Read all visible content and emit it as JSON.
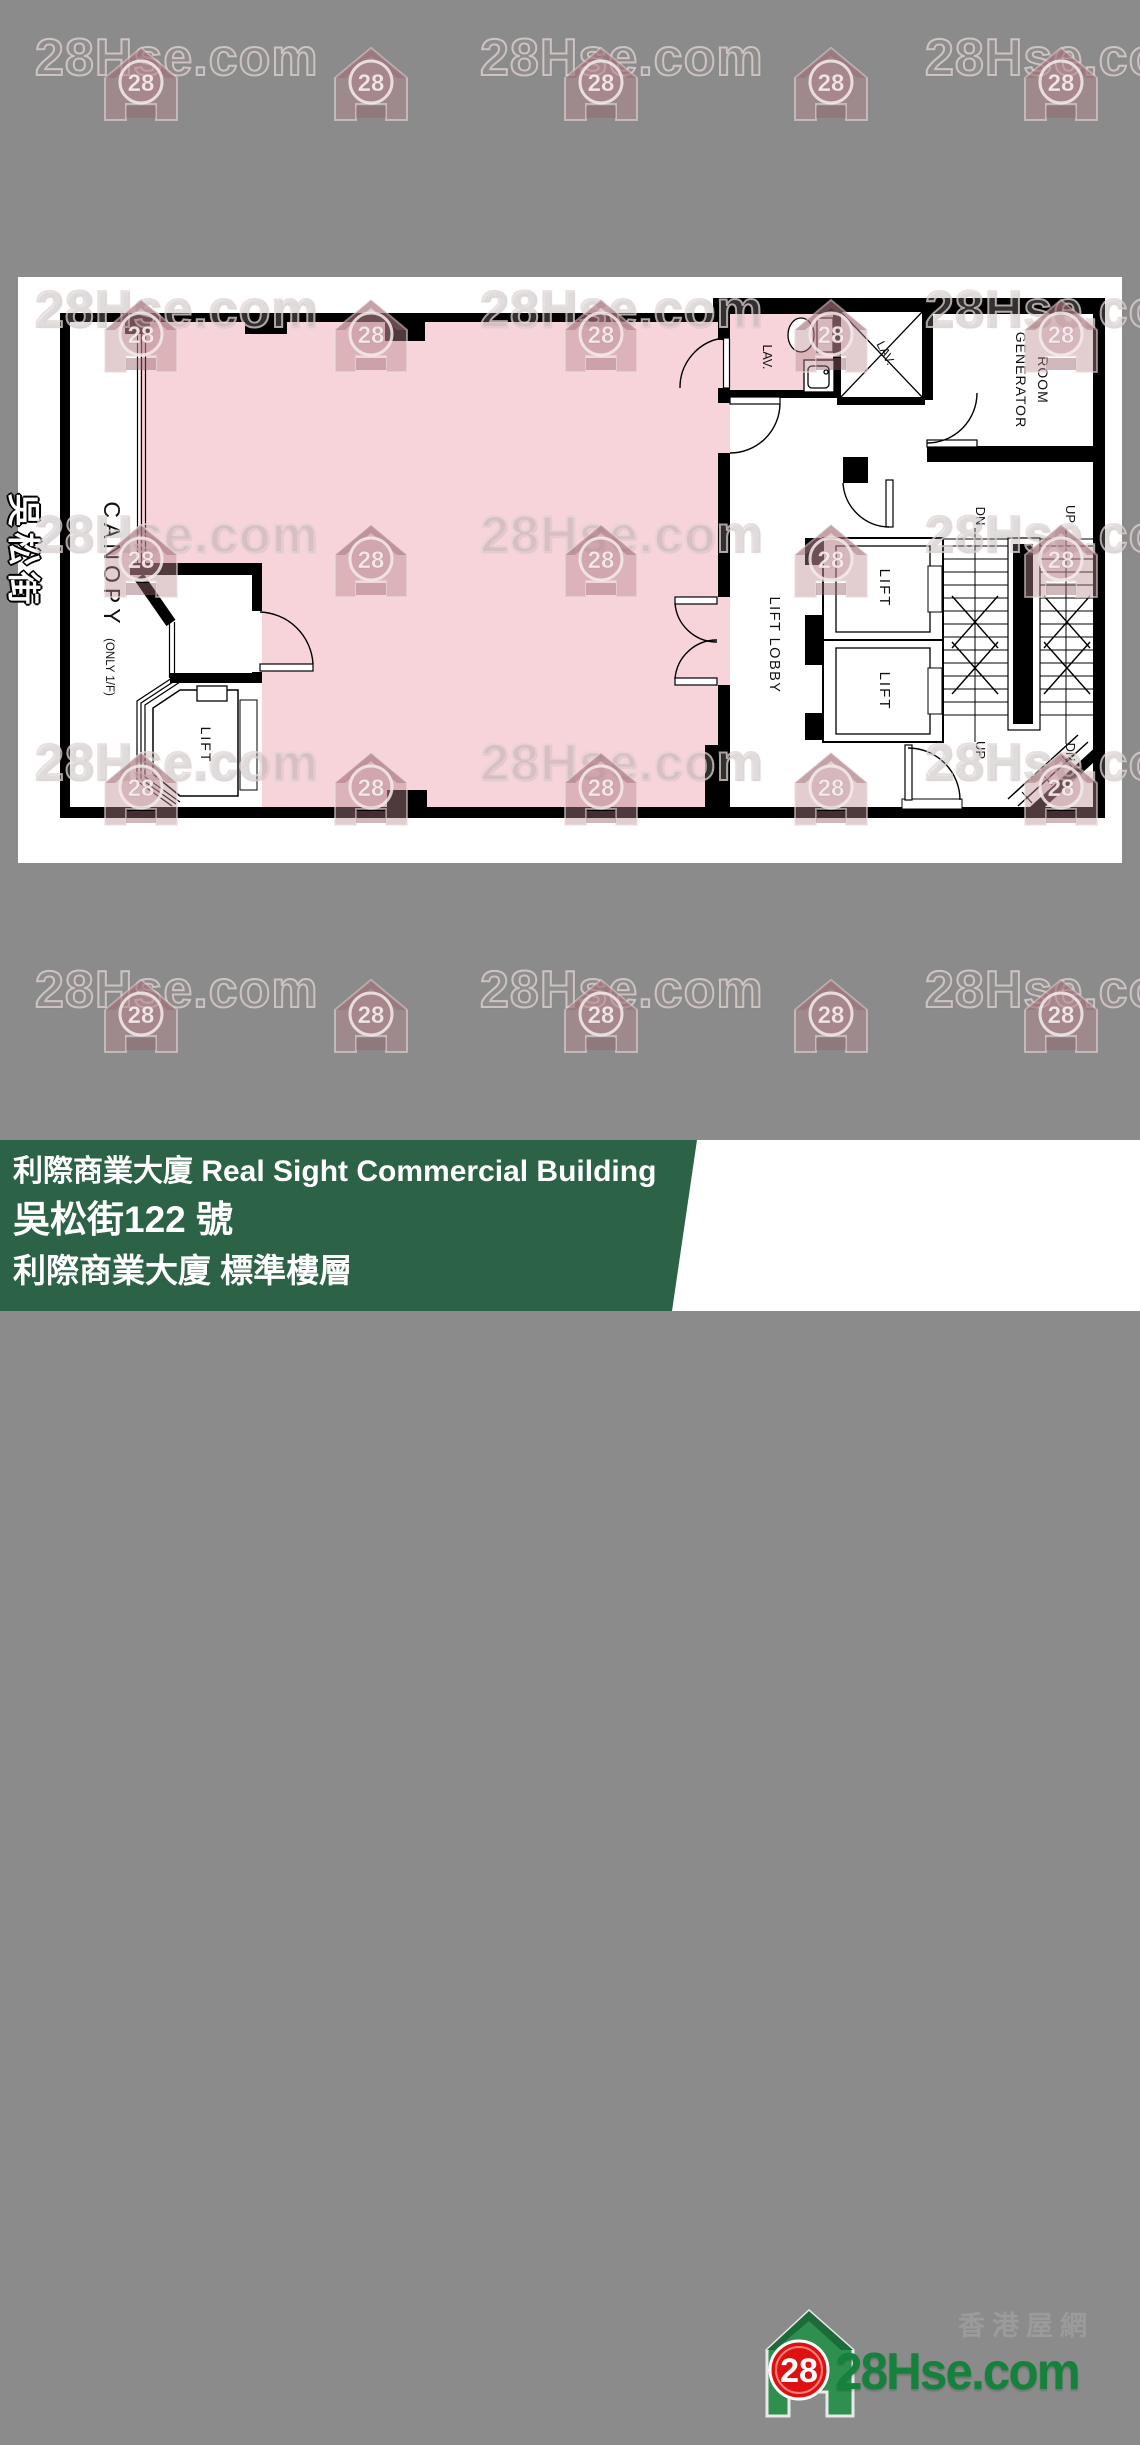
{
  "watermark": {
    "text": "28Hse.com",
    "badge": "28"
  },
  "plan": {
    "street": "吳松街",
    "canopy": "CANOPY",
    "canopy_note": "(ONLY 1/F)",
    "lift": "LIFT",
    "lift_lobby": "LIFT LOBBY",
    "lav": "LAV.",
    "generator_1": "GENERATOR",
    "generator_2": "ROOM",
    "up": "UP",
    "dn": "DN"
  },
  "footer": {
    "line1": "利際商業大廈 Real Sight Commercial Building",
    "line2": "吳松街122 號",
    "line3": "利際商業大廈 標準樓層"
  },
  "logo": {
    "badge": "28",
    "site": "28Hse.com",
    "tagline": "香港屋網"
  },
  "colors": {
    "background": "#8b8b8b",
    "unit_fill": "#f7d3da",
    "wall": "#000000",
    "footer_green": "#2c6246",
    "logo_green": "#15813c",
    "logo_red": "#dd1111"
  }
}
